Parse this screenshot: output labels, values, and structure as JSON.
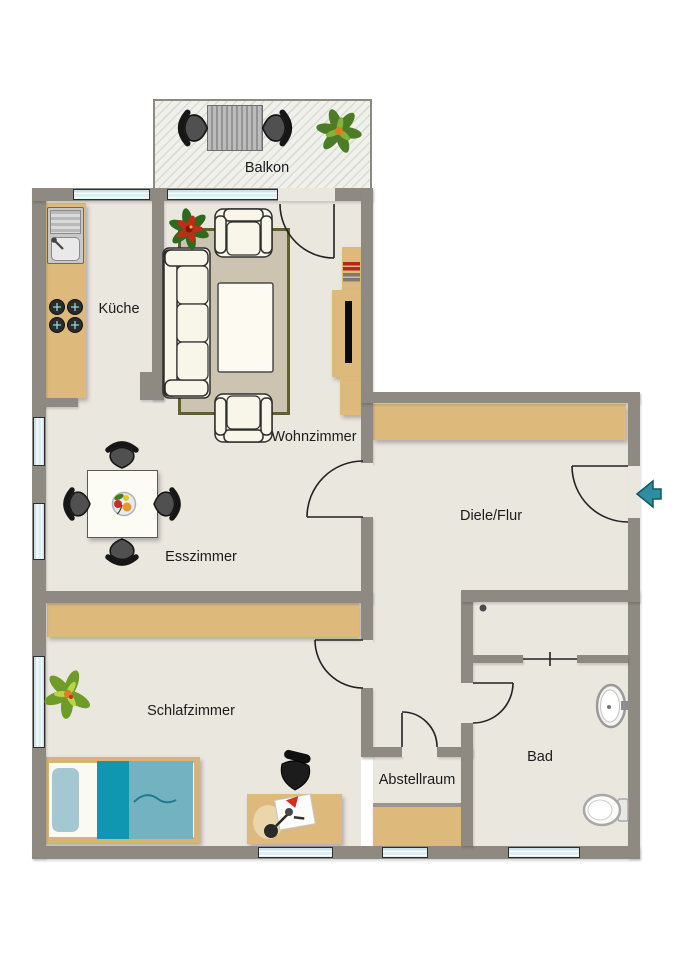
{
  "rooms": {
    "balkon": "Balkon",
    "kueche": "Küche",
    "wohnzimmer": "Wohnzimmer",
    "esszimmer": "Esszimmer",
    "diele": "Diele/Flur",
    "schlafzimmer": "Schlafzimmer",
    "abstellraum": "Abstellraum",
    "bad": "Bad"
  },
  "entry": {
    "marker": "entrance-arrow-left"
  },
  "colors": {
    "wall": "#8E8A82",
    "floor": "#EAE7DF",
    "furniture_wood": "#DDB97B",
    "window_glass": "#C9E3E9",
    "rug_border": "#60602F",
    "rug_fill": "#CCC4B1",
    "bed_blanket": "#73B2C0",
    "bed_blanket_dark": "#0F97B1",
    "entry_arrow": "#2F8DA0"
  }
}
